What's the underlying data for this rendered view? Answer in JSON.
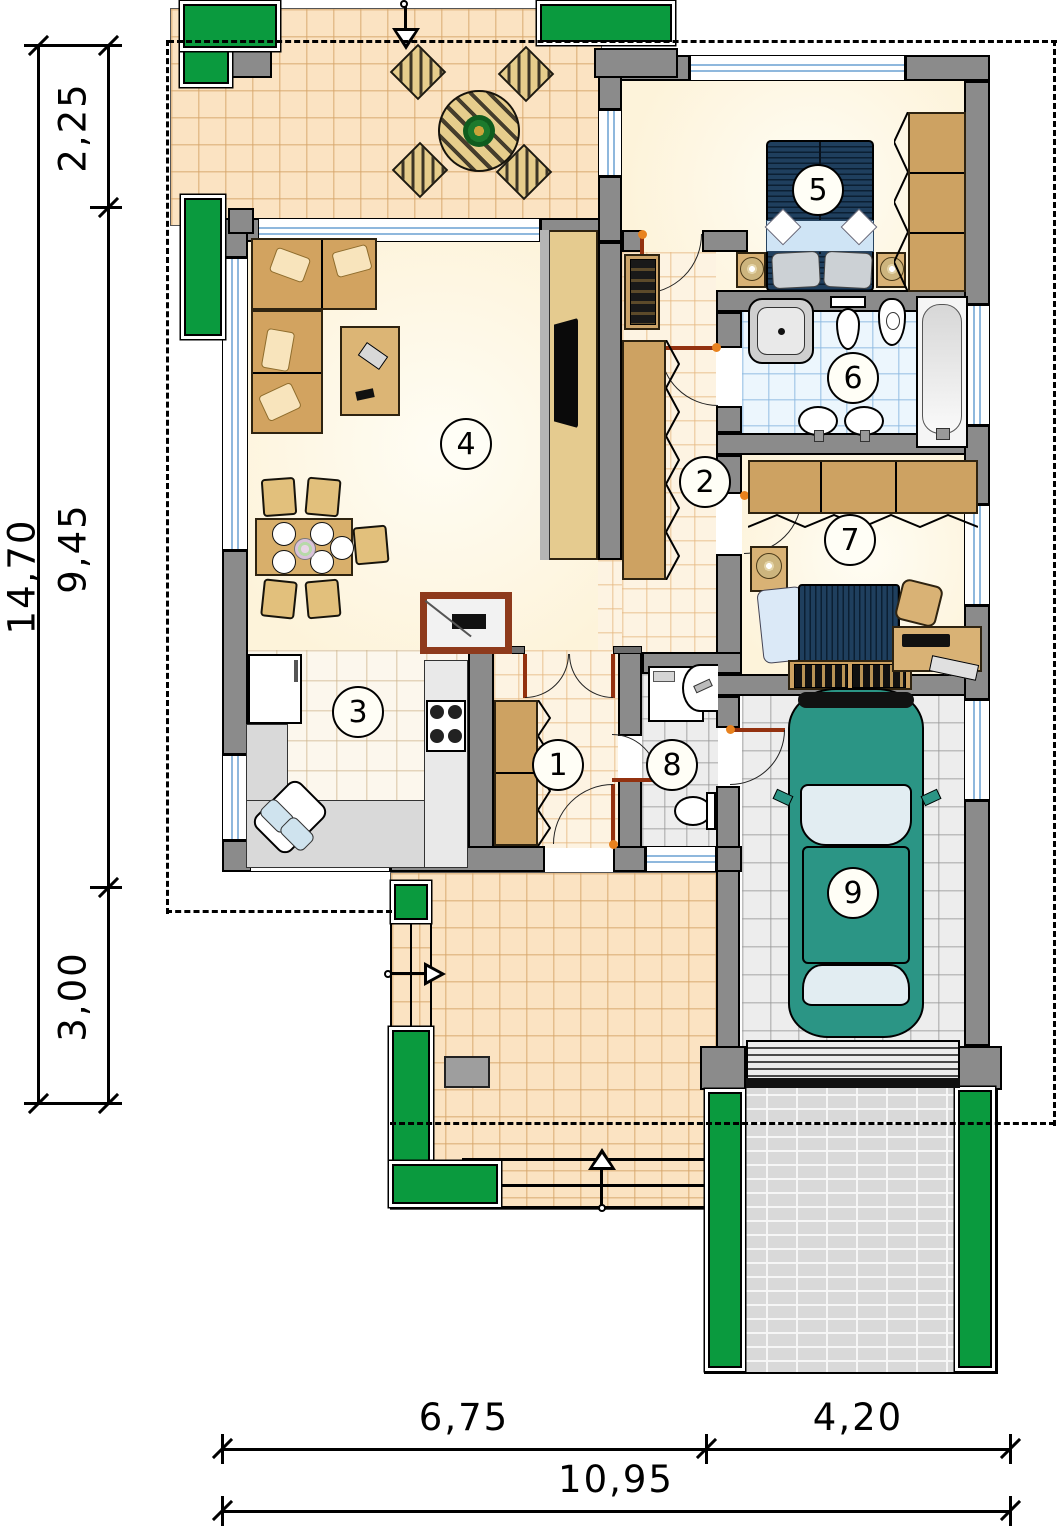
{
  "plan_type": "house-floor-plan",
  "dimensions": {
    "left_total": "14,70",
    "left_segments": [
      "2,25",
      "9,45",
      "3,00"
    ],
    "bottom_segments": [
      "6,75",
      "4,20"
    ],
    "bottom_total": "10,95"
  },
  "rooms": [
    {
      "number": "1"
    },
    {
      "number": "2"
    },
    {
      "number": "3"
    },
    {
      "number": "4"
    },
    {
      "number": "5"
    },
    {
      "number": "6"
    },
    {
      "number": "7"
    },
    {
      "number": "8"
    },
    {
      "number": "9"
    }
  ],
  "colors": {
    "wall": "#8b8b8b",
    "terrace_tile": "#fbe3c2",
    "bathroom_tile": "#ecf6fd",
    "garage_floor": "#ededed",
    "plant_green": "#0a9a3e",
    "car_teal": "#2b9585",
    "wood": "#d2a360",
    "bed_navy": "#1f3f5e",
    "door_brown": "#93310f",
    "driveway_brick": "#d9d9d9"
  }
}
